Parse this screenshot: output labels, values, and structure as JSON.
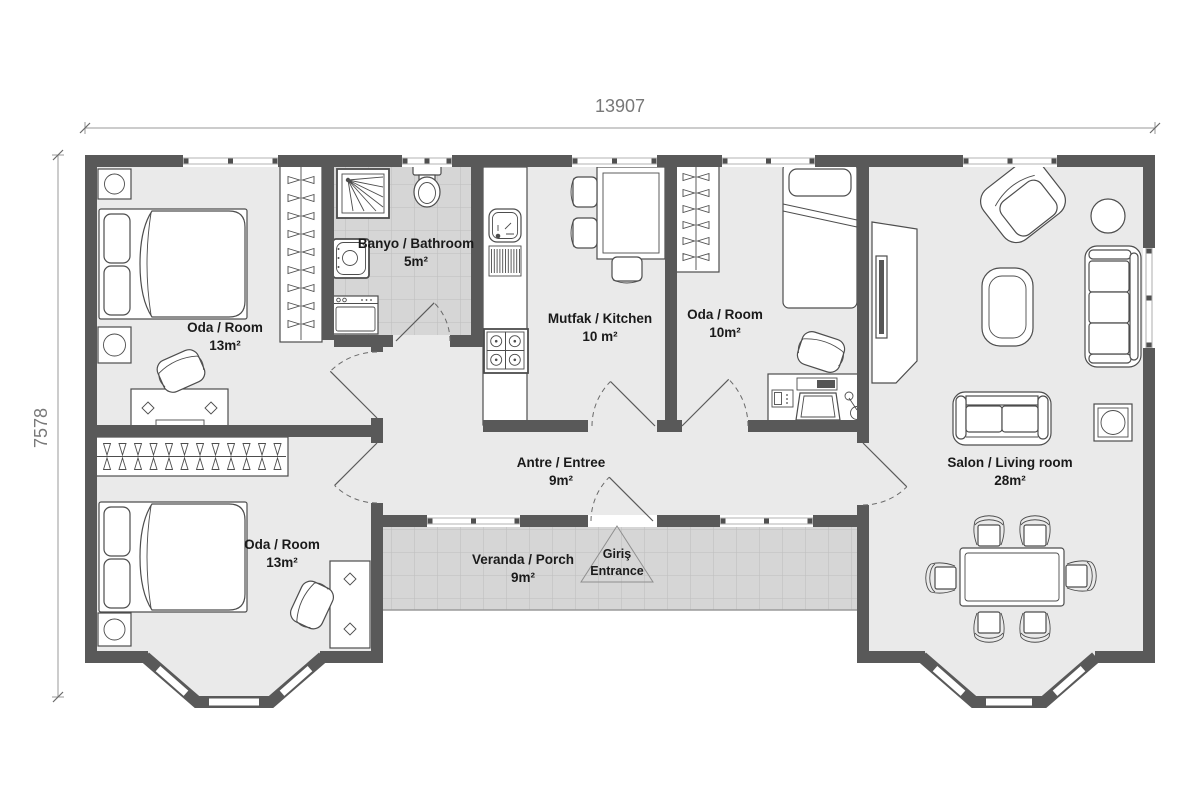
{
  "plan": {
    "dim_width": "13907",
    "dim_height": "7578"
  },
  "rooms": {
    "bedroom1": {
      "name": "Oda / Room",
      "area": "13m²"
    },
    "bathroom": {
      "name": "Banyo / Bathroom",
      "area": "5m²"
    },
    "kitchen": {
      "name": "Mutfak / Kitchen",
      "area": "10 m²"
    },
    "bedroom2": {
      "name": "Oda / Room",
      "area": "10m²"
    },
    "living_room": {
      "name": "Salon / Living room",
      "area": "28m²"
    },
    "hallway": {
      "name": "Antre / Entree",
      "area": "9m²"
    },
    "bedroom3": {
      "name": "Oda / Room",
      "area": "13m²"
    },
    "porch": {
      "name": "Veranda / Porch",
      "area": "9m²"
    }
  },
  "entrance": {
    "label_tr": "Giriş",
    "label_en": "Entrance"
  },
  "colors": {
    "wall": "#595959",
    "floor": "#eaeaea",
    "tile": "#d6d6d6",
    "outline": "#4d4d4d"
  }
}
